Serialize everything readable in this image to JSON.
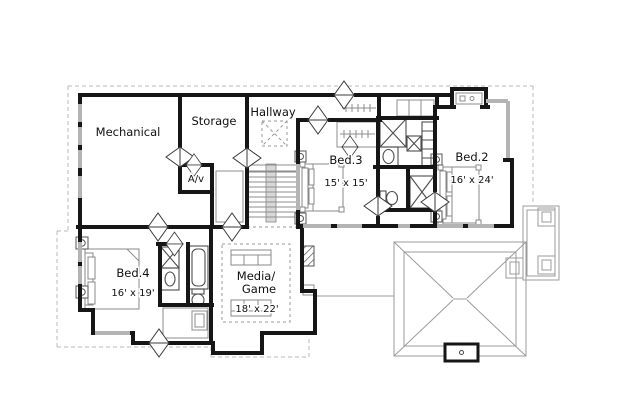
{
  "plan": {
    "type": "floor-plan",
    "rooms": {
      "mechanical": {
        "label": "Mechanical"
      },
      "storage": {
        "label": "Storage"
      },
      "hallway": {
        "label": "Hallway"
      },
      "av_closet": {
        "label": "A/v"
      },
      "bed3": {
        "label": "Bed.3",
        "size": "15' x 15'"
      },
      "bed2": {
        "label": "Bed.2",
        "size": "16' x 24'"
      },
      "bed4": {
        "label": "Bed.4",
        "size": "16' x 19'"
      },
      "media_game": {
        "label_line1": "Media/",
        "label_line2": "Game",
        "size": "18' x 22'"
      }
    },
    "colors": {
      "background": "#ffffff",
      "wall": "#161616",
      "window": "#b4b4b4",
      "furniture": "#888888",
      "roof_line": "#9b9b9b",
      "text": "#111111"
    }
  }
}
